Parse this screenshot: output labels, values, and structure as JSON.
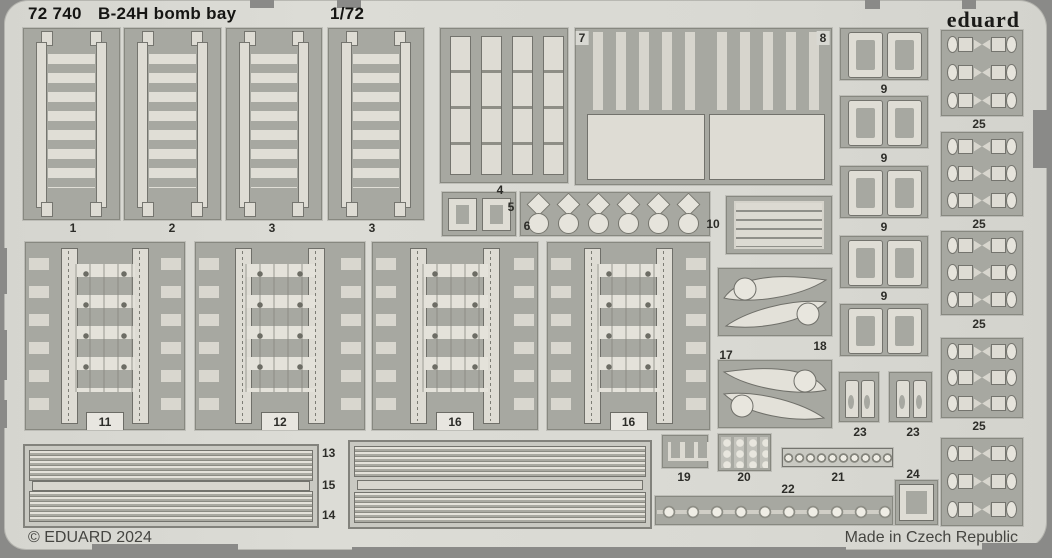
{
  "header": {
    "catalog_number": "72 740",
    "title": "B-24H bomb bay",
    "scale": "1/72",
    "brand": "eduard"
  },
  "footer": {
    "copyright": "© EDUARD 2024",
    "made_in": "Made in Czech Republic"
  },
  "colors": {
    "background": "#8a8a88",
    "sheet": "#d9d9d3",
    "part_backing": "#a7a8a1",
    "etched_part": "#dfddd5",
    "text": "#2c2c28"
  },
  "labels": {
    "p1": "1",
    "p2": "2",
    "p3a": "3",
    "p3b": "3",
    "p4": "4",
    "p5": "5",
    "p6": "6",
    "p7": "7",
    "p8": "8",
    "p9a": "9",
    "p9b": "9",
    "p9c": "9",
    "p9d": "9",
    "p10": "10",
    "p11": "11",
    "p12": "12",
    "p13": "13",
    "p14": "14",
    "p15": "15",
    "p16a": "16",
    "p16b": "16",
    "p17": "17",
    "p18": "18",
    "p19": "19",
    "p20": "20",
    "p21": "21",
    "p22": "22",
    "p23a": "23",
    "p23b": "23",
    "p24": "24",
    "p25a": "25",
    "p25b": "25",
    "p25c": "25",
    "p25d": "25"
  }
}
